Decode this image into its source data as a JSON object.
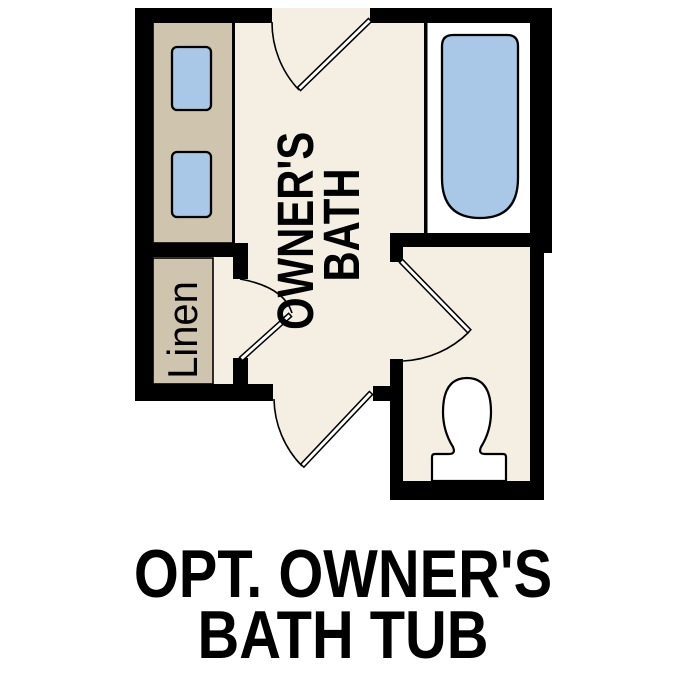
{
  "labels": {
    "room": {
      "line1": "OWNER'S",
      "line2": "BATH"
    },
    "linen": "Linen",
    "caption": {
      "line1": "OPT. OWNER'S",
      "line2": "BATH TUB"
    }
  },
  "colors": {
    "background": "#ffffff",
    "floor": "#f5efe3",
    "cabinet": "#cfc4ae",
    "fixture_blue": "#a9c8e8",
    "alcove_white": "#ffffff",
    "wall": "#000000",
    "outline": "#000000",
    "text": "#000000"
  }
}
